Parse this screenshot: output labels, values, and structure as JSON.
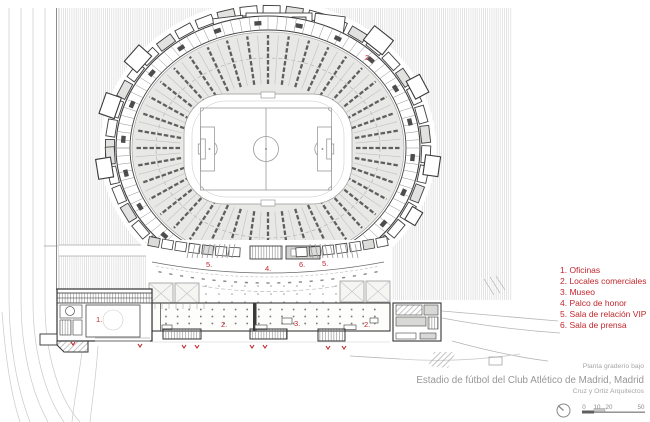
{
  "legend": {
    "items": [
      "1. Oficinas",
      "2. Locales comerciales",
      "3. Museo",
      "4. Palco de honor",
      "5. Sala de relación VIP",
      "6. Sala de prensa"
    ]
  },
  "plan_labels": [
    {
      "text": "2.",
      "x": 365,
      "y": 60
    },
    {
      "text": "5.",
      "x": 206,
      "y": 267
    },
    {
      "text": "4.",
      "x": 265,
      "y": 271
    },
    {
      "text": "6.",
      "x": 299,
      "y": 267
    },
    {
      "text": "5.",
      "x": 322,
      "y": 266
    },
    {
      "text": "1.",
      "x": 96,
      "y": 322
    },
    {
      "text": "2.",
      "x": 221,
      "y": 327
    },
    {
      "text": "3.",
      "x": 294,
      "y": 326
    },
    {
      "text": "2.",
      "x": 364,
      "y": 327
    }
  ],
  "footer": {
    "plan_label": "Planta graderío bajo",
    "title": "Estadio de fútbol del Club Atlético de Madrid, Madrid",
    "architects": "Cruz y Ortiz Arquitectos"
  },
  "scale_bar": {
    "ticks": [
      "0",
      "10",
      "20",
      "50"
    ]
  },
  "colors": {
    "accent": "#c1272d",
    "ink": "#3a3a3a",
    "muted": "#9a9a9a"
  }
}
